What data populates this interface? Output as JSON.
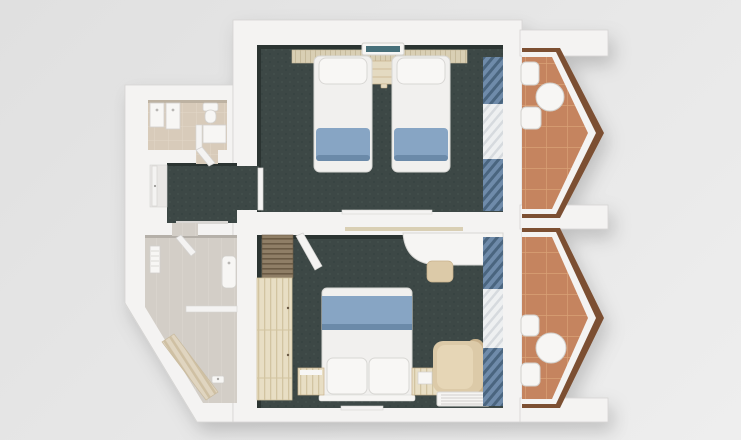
{
  "scene": {
    "title": "3D top-down floor plan render of two hotel rooms",
    "floorplan_type": "two bedrooms with en-suite bathrooms and angled balconies",
    "rooms": [
      {
        "id": "twin-room",
        "label": "twin bedroom",
        "furniture": [
          "headboard-panel",
          "ac-unit",
          "nightstand",
          "twin-bed-left",
          "twin-bed-right",
          "window-curtains"
        ]
      },
      {
        "id": "double-room",
        "label": "double bedroom",
        "furniture": [
          "luggage-rack",
          "wardrobe",
          "double-bed",
          "nightstand-left",
          "nightstand-right",
          "desk",
          "stool",
          "armchair",
          "floor-vent",
          "window-curtains"
        ]
      },
      {
        "id": "hallway",
        "label": "entry hall",
        "furniture": [
          "entry-door"
        ]
      },
      {
        "id": "bathroom-top",
        "label": "bathroom",
        "furniture": [
          "vanity-1",
          "vanity-2",
          "toilet",
          "shower-tray",
          "door-leaf"
        ]
      },
      {
        "id": "bathroom-bottom",
        "label": "bathroom",
        "furniture": [
          "towel-radiator",
          "sink",
          "partition-wall",
          "shower-bench",
          "faucet",
          "door-leaf"
        ]
      },
      {
        "id": "balcony-top",
        "label": "balcony",
        "furniture": [
          "chair",
          "round-table",
          "chair"
        ]
      },
      {
        "id": "balcony-bottom",
        "label": "balcony",
        "furniture": [
          "chair",
          "round-table",
          "chair"
        ]
      }
    ]
  },
  "colors": {
    "bg_from": "#e0e0e0",
    "bg_to": "#eeeeee",
    "wall": "#f4f3f2",
    "wall_edge": "#d5d4d2",
    "wall_shadow": "#c7c6c4",
    "carpet": "#3d4846",
    "carpet_shadow": "#2b3432",
    "balcony_tile": "#c5845e",
    "balcony_grout": "#d9a176",
    "wood_trim": "#7c4f33",
    "curtain_blue": "#6f8baa",
    "curtain_blue_dark": "#4a657f",
    "sheer": "#eef0f1",
    "sheer_line": "#d6dade",
    "bed_white": "#f1f0ee",
    "bed_stroke": "#d8d7d4",
    "pillow": "#f8f7f5",
    "runner_blue": "#87a5c4",
    "runner_shadow": "#6b8aa9",
    "headboard": "#d9cfb4",
    "headboard_line": "#c6ba9b",
    "nightstand": "#e4dac1",
    "wood_light": "#e8dec4",
    "wood_light_line": "#d2c4a1",
    "wood_slat": "#8f7e66",
    "wood_slat_line": "#6a5a44",
    "beige": "#dccaa8",
    "beige_dark": "#c9b28c",
    "beige_light": "#e6d6b6",
    "desk_white": "#f6f5f3",
    "ac_teal": "#47707a",
    "bath_floor": "#d8cbba",
    "bath_floor_line": "#e2d7c8",
    "bath_floor_cool": "#d3cec7",
    "bath_floor_cool_line": "#dcd7d0",
    "fixture_white": "#f7f6f4",
    "fixture_stroke": "#d2d0cc"
  }
}
